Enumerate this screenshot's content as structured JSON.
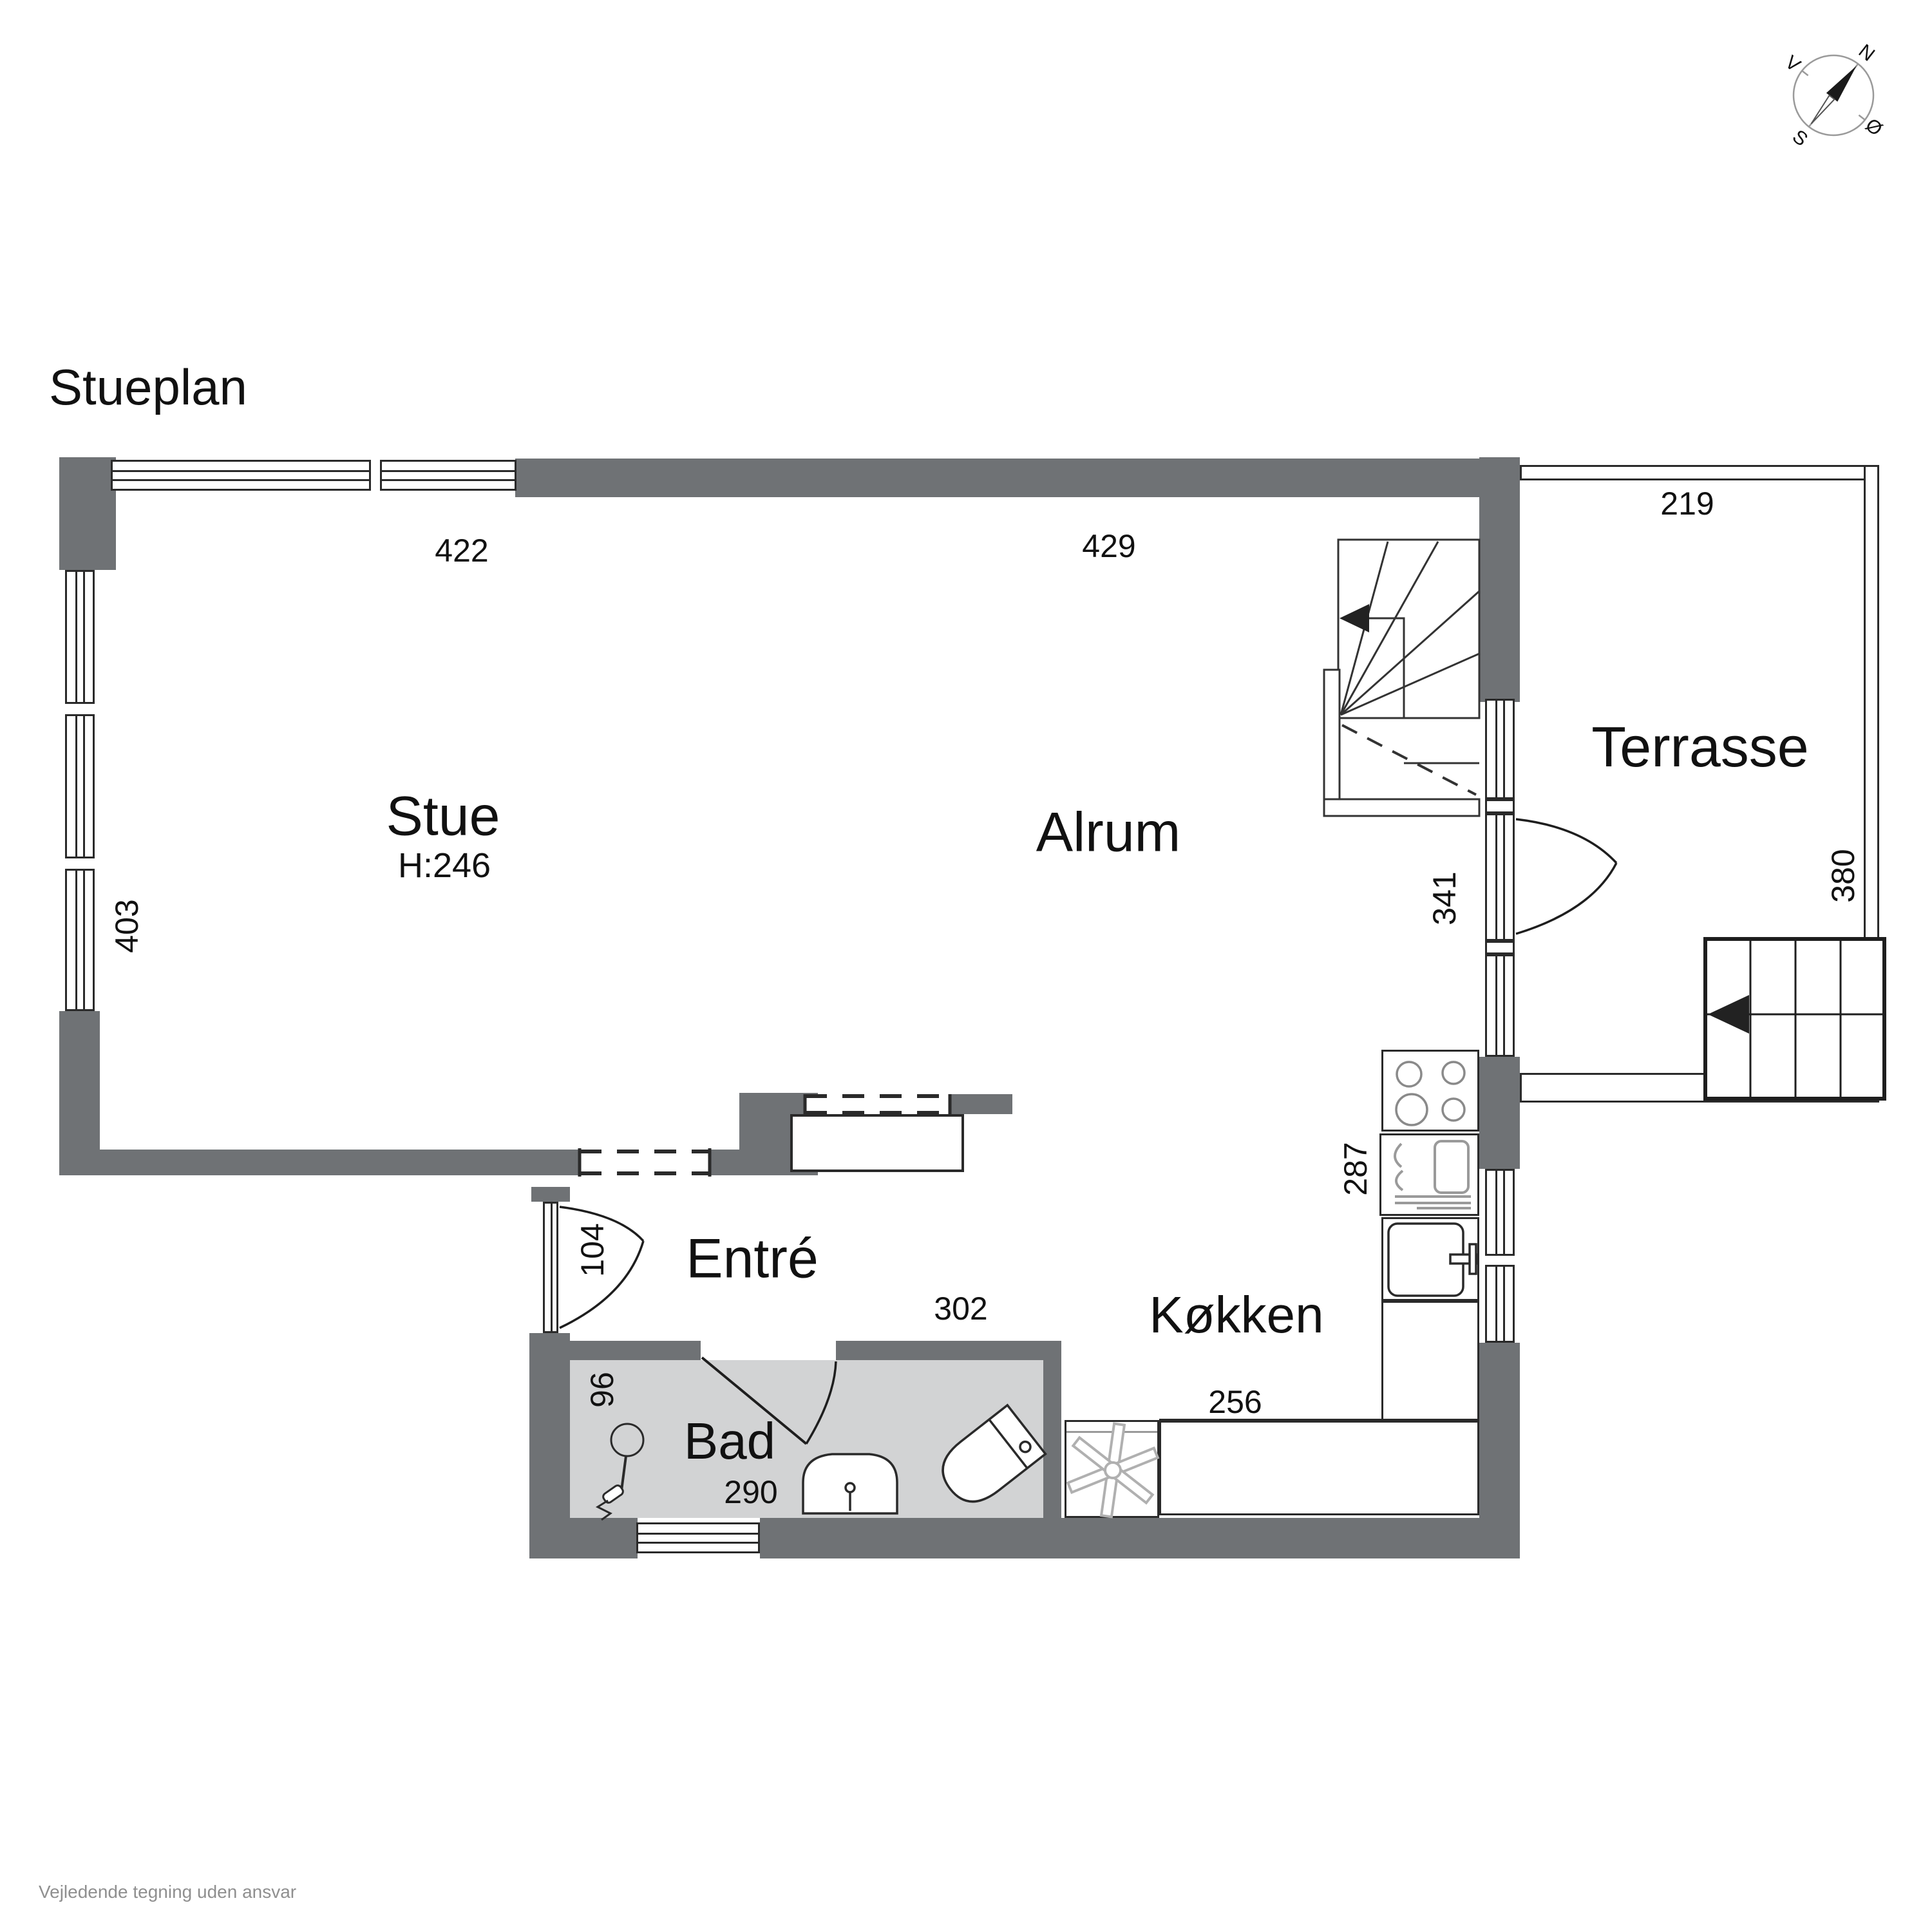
{
  "title": "Stueplan",
  "disclaimer": "Vejledende tegning uden ansvar",
  "compass": {
    "north": "N",
    "east": "Ø",
    "south": "S",
    "west": "V"
  },
  "rooms": {
    "stue": {
      "label": "Stue",
      "height_note": "H:246"
    },
    "alrum": {
      "label": "Alrum"
    },
    "terrasse": {
      "label": "Terrasse"
    },
    "entre": {
      "label": "Entré"
    },
    "kokken": {
      "label": "Køkken"
    },
    "bad": {
      "label": "Bad"
    }
  },
  "dimensions": {
    "stue_width": "422",
    "alrum_width": "429",
    "terrasse_width": "219",
    "stue_depth": "403",
    "terrasse_depth": "380",
    "alrum_right_depth": "341",
    "kokken_depth": "287",
    "kokken_counter_width": "256",
    "entre_door_width": "104",
    "bad_depth": "96",
    "entre_width": "302",
    "bad_width": "290"
  },
  "colors": {
    "wall": "#6f7275",
    "bad_floor": "#d2d3d4",
    "line": "#2a2a2a",
    "fixture_muted": "#9a9a9a",
    "text": "#111111",
    "disclaimer_text": "#8f8f8f"
  }
}
